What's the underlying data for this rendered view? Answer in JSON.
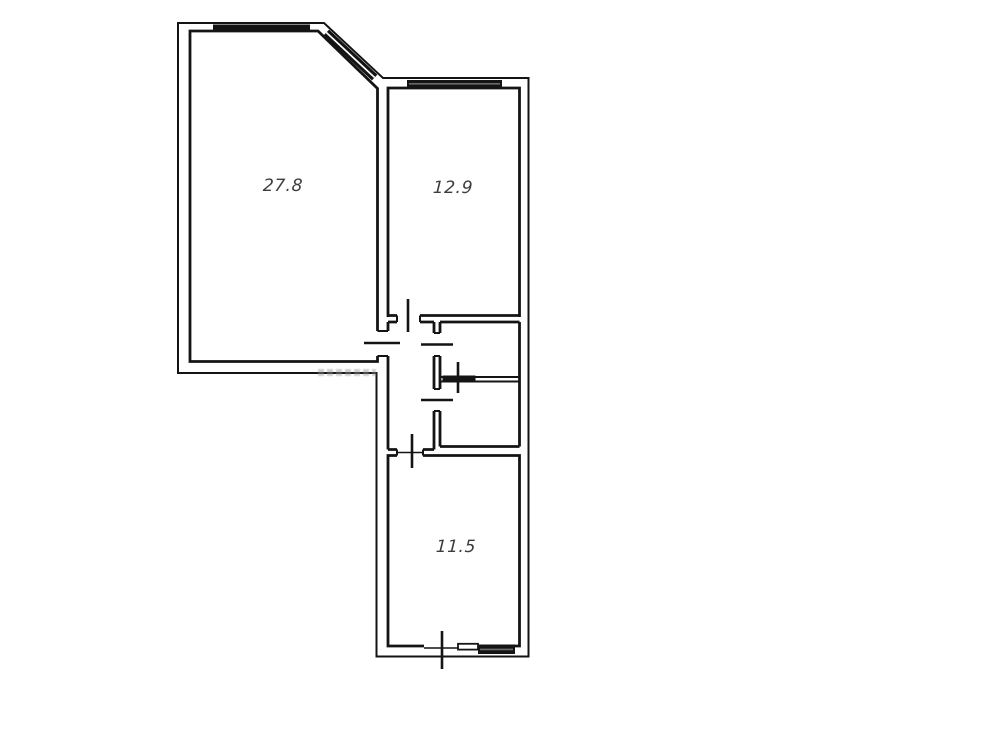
{
  "floorplan": {
    "background": "#ffffff",
    "wall_color": "#141414",
    "label_color": "#3d3d3d",
    "rooms": [
      {
        "area": "27.8"
      },
      {
        "area": "12.9"
      },
      {
        "area": "11.5"
      }
    ]
  }
}
